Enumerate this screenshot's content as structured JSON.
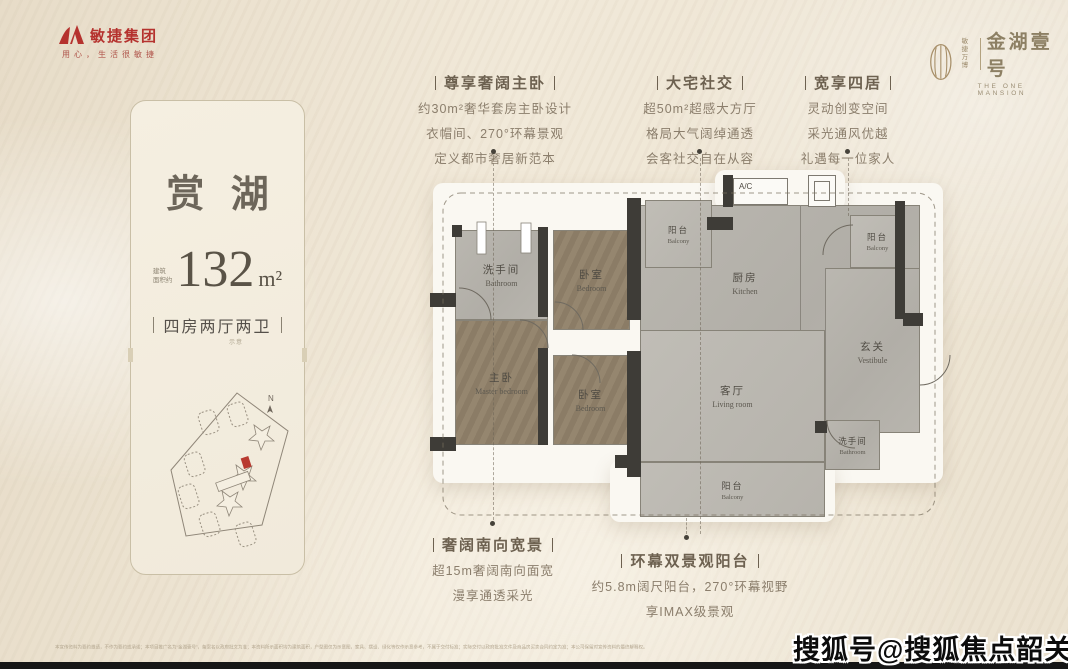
{
  "brand": {
    "developer": {
      "name": "敏捷集团",
      "tagline": "用心，生活很敏捷",
      "logo_color": "#b5322e"
    },
    "project": {
      "prefix": [
        "敏捷",
        "万博"
      ],
      "name": "金湖壹号",
      "name_en": "THE ONE MANSION",
      "accent_color": "#a8906a"
    }
  },
  "info_card": {
    "title": "赏湖",
    "area_prefix": [
      "建筑",
      "面积约"
    ],
    "area_value": "132",
    "area_unit": "m²",
    "layout_badge": "四房两厅两卫",
    "layout_note": "示意",
    "siteplan": {
      "compass": "N"
    }
  },
  "callouts": {
    "top": [
      {
        "title": "尊享奢阔主卧",
        "lines": [
          "约30m²奢华套房主卧设计",
          "衣帽间、270°环幕景观",
          "定义都市奢居新范本"
        ]
      },
      {
        "title": "大宅社交",
        "lines": [
          "超50m²超感大方厅",
          "格局大气阔绰通透",
          "会客社交自在从容"
        ]
      },
      {
        "title": "宽享四居",
        "lines": [
          "灵动创变空间",
          "采光通风优越",
          "礼遇每一位家人"
        ]
      }
    ],
    "bottom": [
      {
        "title": "奢阔南向宽景",
        "lines": [
          "超15m奢阔南向面宽",
          "漫享通透采光"
        ]
      },
      {
        "title": "环幕双景观阳台",
        "lines": [
          "约5.8m阔尺阳台，270°环幕视野",
          "享IMAX级景观"
        ]
      }
    ]
  },
  "floorplan": {
    "ac_label": "A/C",
    "rooms": [
      {
        "cn": "洗手间",
        "en": "Bathroom"
      },
      {
        "cn": "卧室",
        "en": "Bedroom"
      },
      {
        "cn": "主卧",
        "en": "Master bedroom"
      },
      {
        "cn": "卧室",
        "en": "Bedroom"
      },
      {
        "cn": "厨房",
        "en": "Kitchen"
      },
      {
        "cn": "客厅",
        "en": "Living room"
      },
      {
        "cn": "玄关",
        "en": "Vestibule"
      },
      {
        "cn": "洗手间",
        "en": "Bathroom"
      },
      {
        "cn": "阳台",
        "en": "Balcony"
      },
      {
        "cn": "阳台",
        "en": "Balcony"
      },
      {
        "cn": "阳台",
        "en": "Balcony"
      }
    ]
  },
  "footer": {
    "disclaimer": "本宣传资料为要约邀请，不作为要约或承诺；本项目推广名为“金湖壹号”，备案名以政府批文为准；本资料所示面积均为建筑面积，户型图仅为示意图，家具、摆设、绿化等仅作示意参考，不属于交付标准；实际交付以政府批准文件及商品房买卖合同约定为准；本公司保留对宣传资料的最终解释权。",
    "watermark": "搜狐号@搜狐焦点韶关站"
  }
}
